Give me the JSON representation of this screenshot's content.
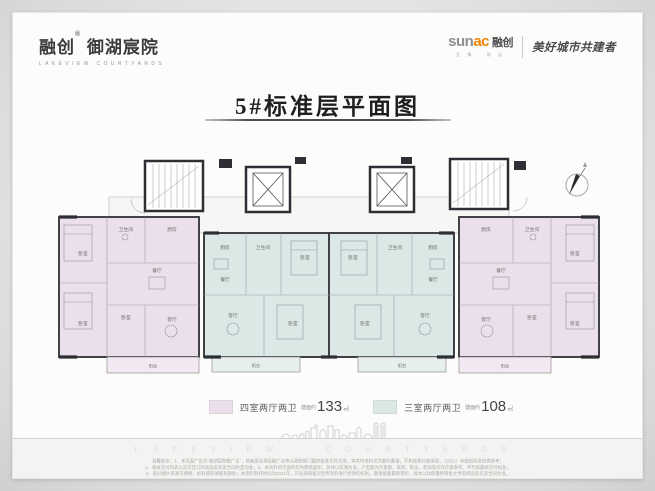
{
  "brand": {
    "name_cn": "融创",
    "reg_mark": "®",
    "project_cn": "御湖宸院",
    "project_en": "LAKEVIEW COURTYARDS",
    "sunac_sun": "sun",
    "sunac_ac": "ac",
    "sunac_cn": "融创",
    "sunac_sub": "至 臻 · 致 远",
    "sunac_slogan": "美好城市共建者"
  },
  "title": {
    "text": "5#标准层平面图"
  },
  "rooms": {
    "bedroom": "卧室",
    "living": "客厅",
    "dining": "餐厅",
    "kitchen": "厨房",
    "bath": "卫生间",
    "balcony": "阳台"
  },
  "legend": {
    "item1": {
      "label": "四室两厅两卫",
      "prefix": "建面约",
      "area": "133",
      "unit": "㎡",
      "color": "#ecdfec"
    },
    "item2": {
      "label": "三室两厅两卫",
      "prefix": "建面约",
      "area": "108",
      "unit": "㎡",
      "color": "#dbe8e6"
    }
  },
  "colors": {
    "unit_pink": "#ecdfec",
    "unit_teal": "#dbe8e6",
    "wall_dark": "#2e2e35",
    "accent_orange": "#f08300"
  },
  "footer": {
    "watermark": "LAKEVIEW COURTYARDS",
    "disclaimer_line1": "温馨提示：1、本页面广告为“御湖宸院推广名”，其备案名称及推广名等以政府部门最终批准文件为准；本宣传资料仅为要约邀请，不构成要约或承诺，（2021）年规划信息仅供参考；",
    "disclaimer_line2": "2、相关交付内容以双方签订的商品房买卖合同约定为准；3、本资料所示面积均为建筑面积，具体以实测为准；户型图为示意图，家具、陈设、装饰等仅作示意参考，不代表最终交付标准；",
    "disclaimer_line3": "4、部分图片来源于网络，如有侵权请联系删除；本资料制作时间为2021年，开发商保留对宣传资料进行修改的权利，敬请留意最新资料，具体以政府最终审批文件及商品房买卖合同为准。"
  }
}
